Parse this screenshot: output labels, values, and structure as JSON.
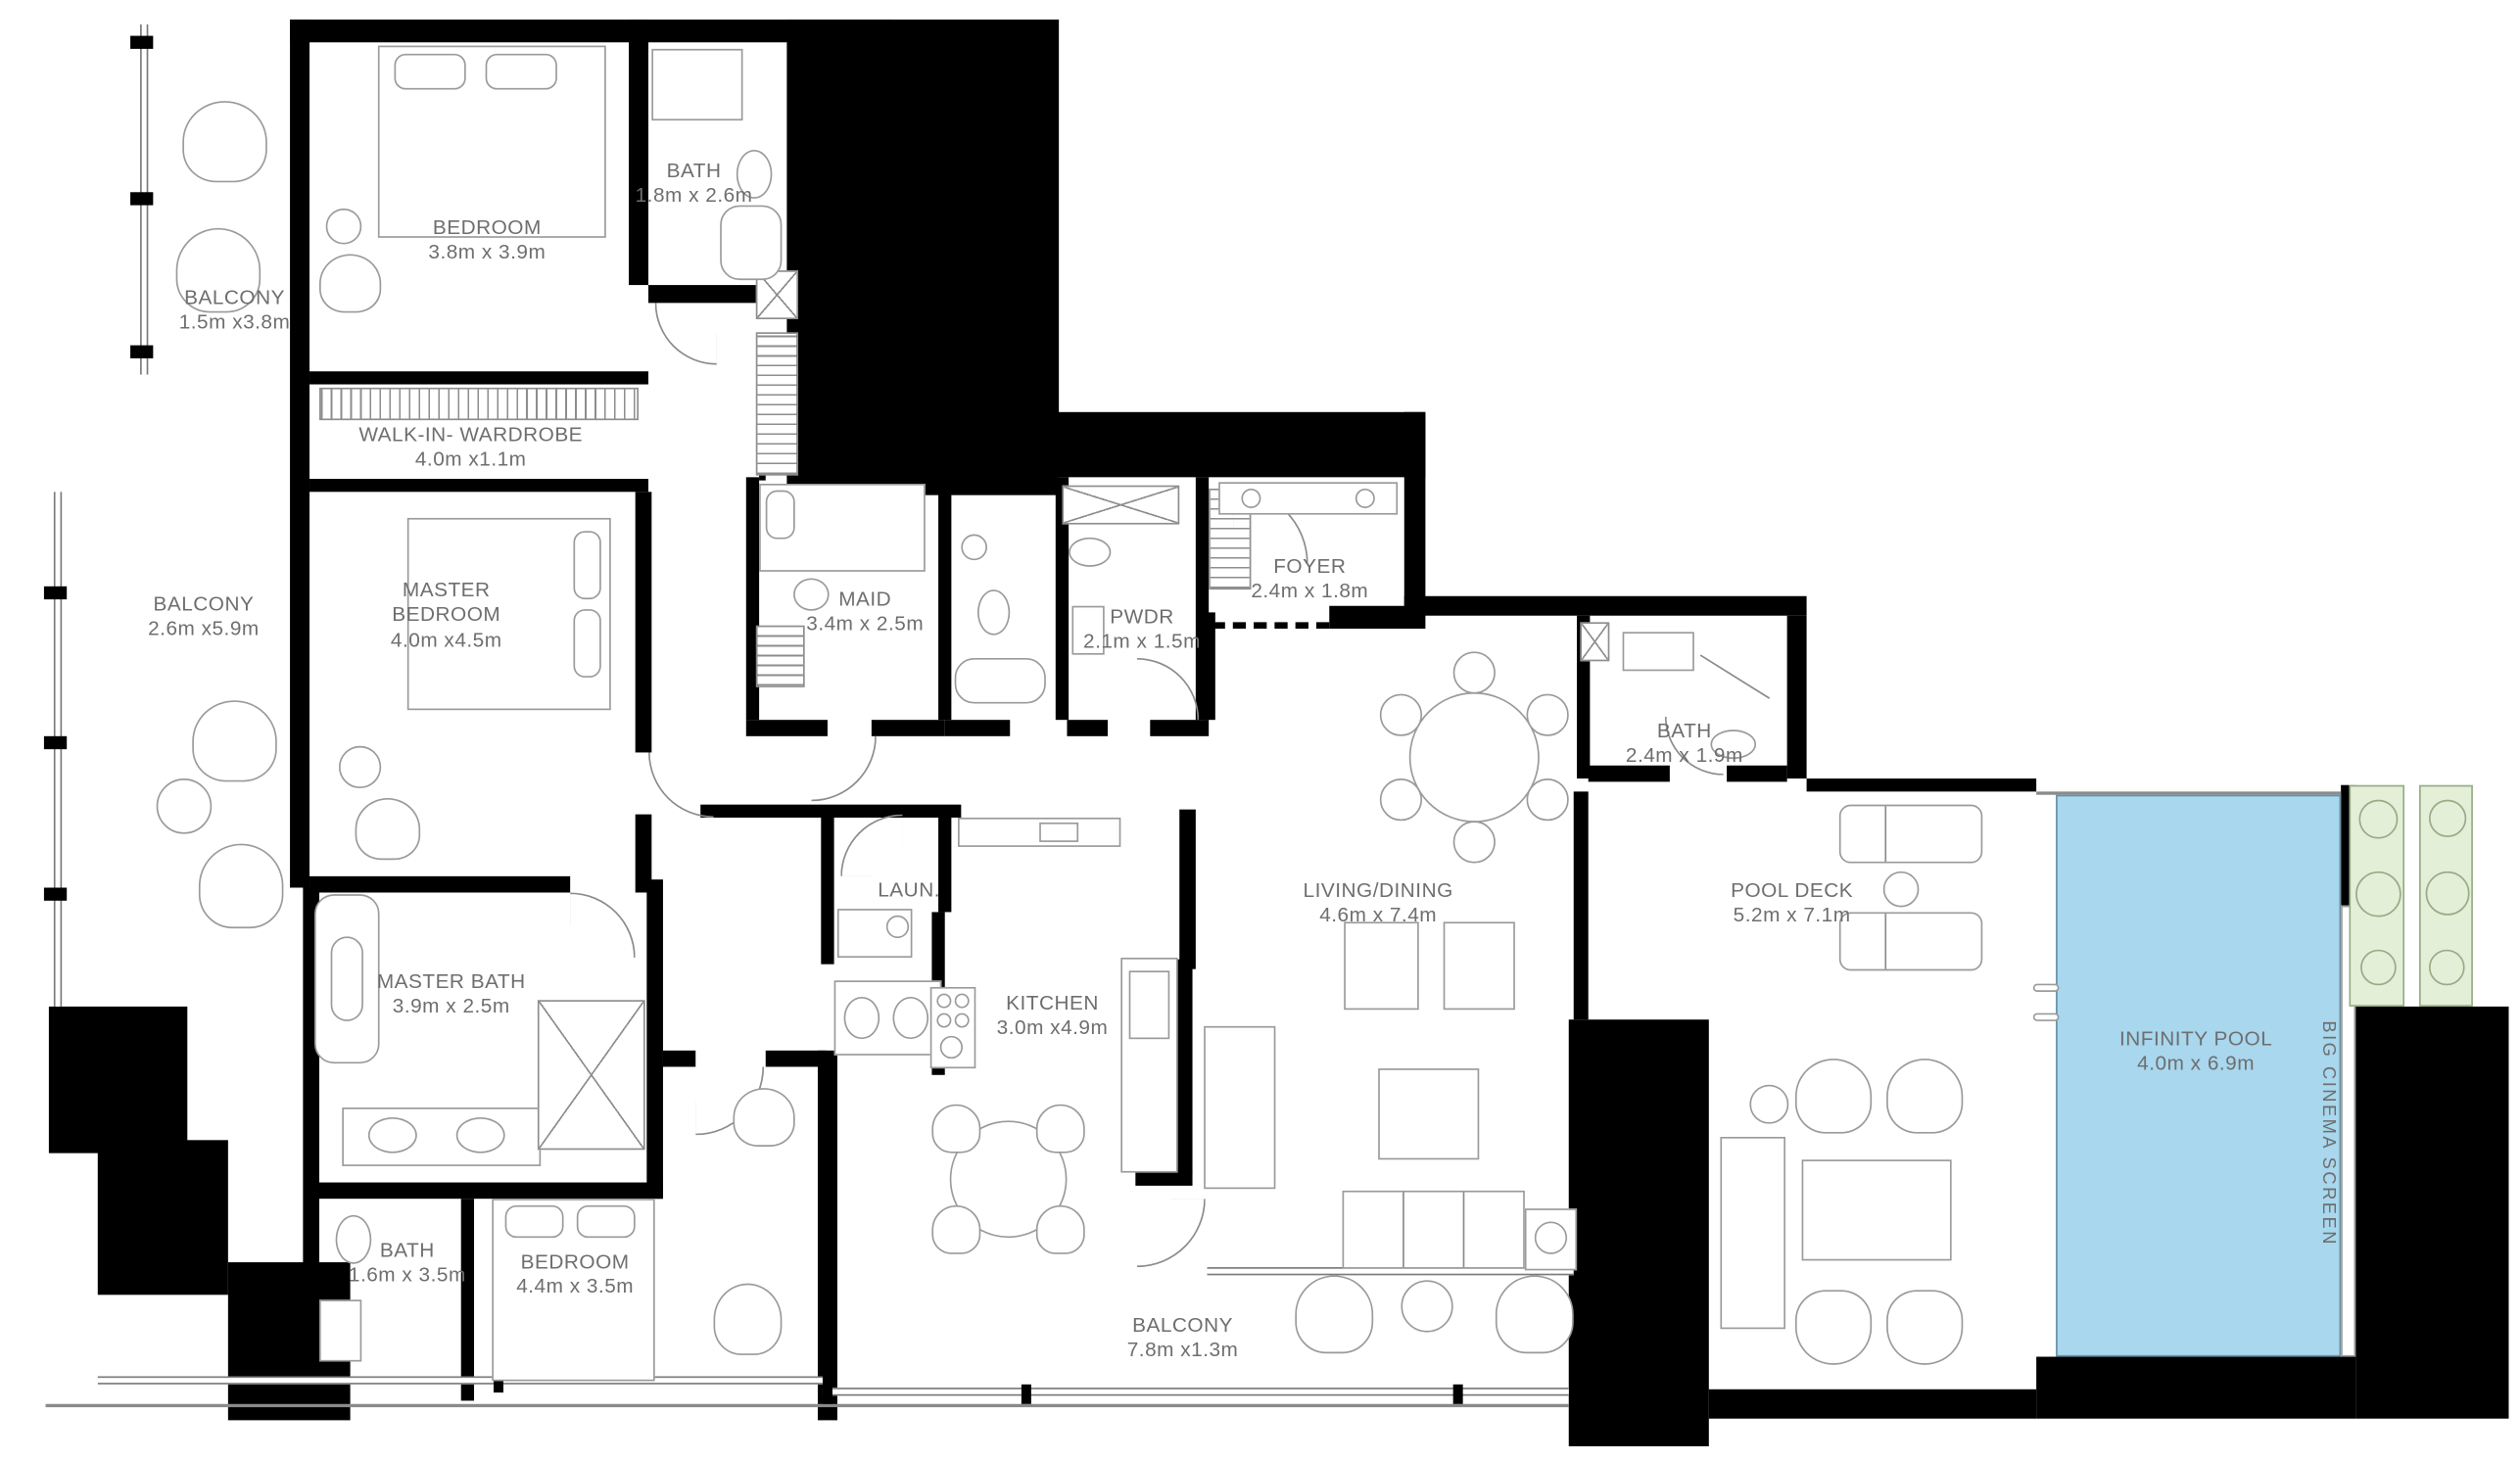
{
  "colors": {
    "wall": "#000000",
    "pool_fill": "#a8d7ee",
    "pool_border": "#6b8fa3",
    "planter_fill": "#e3efd7",
    "planter_border": "#97ab85",
    "label_color": "#6e6e6e"
  },
  "rooms": [
    {
      "id": "balcony-top",
      "name": "BALCONY",
      "dims": "1.5m x3.8m"
    },
    {
      "id": "bedroom-top",
      "name": "BEDROOM",
      "dims": "3.8m x 3.9m"
    },
    {
      "id": "bath-top",
      "name": "BATH",
      "dims": "1.8m x 2.6m"
    },
    {
      "id": "walk-in-wardrobe",
      "name": "WALK-IN- WARDROBE",
      "dims": "4.0m x1.1m"
    },
    {
      "id": "balcony-left",
      "name": "BALCONY",
      "dims": "2.6m x5.9m"
    },
    {
      "id": "master-bedroom",
      "name": "MASTER BEDROOM",
      "dims": "4.0m x4.5m"
    },
    {
      "id": "maid",
      "name": "MAID",
      "dims": "3.4m x 2.5m"
    },
    {
      "id": "pwdr",
      "name": "PWDR",
      "dims": "2.1m x 1.5m"
    },
    {
      "id": "foyer",
      "name": "FOYER",
      "dims": "2.4m x 1.8m"
    },
    {
      "id": "bath-guest",
      "name": "BATH",
      "dims": "2.4m x 1.9m"
    },
    {
      "id": "living-dining",
      "name": "LIVING/DINING",
      "dims": "4.6m x 7.4m"
    },
    {
      "id": "pool-deck",
      "name": "POOL DECK",
      "dims": "5.2m x 7.1m"
    },
    {
      "id": "infinity-pool",
      "name": "INFINITY POOL",
      "dims": "4.0m x 6.9m"
    },
    {
      "id": "master-bath",
      "name": "MASTER BATH",
      "dims": "3.9m x 2.5m"
    },
    {
      "id": "laundry",
      "name": "LAUN.",
      "dims": ""
    },
    {
      "id": "kitchen",
      "name": "KITCHEN",
      "dims": "3.0m x4.9m"
    },
    {
      "id": "bath-3",
      "name": "BATH",
      "dims": "1.6m x 3.5m"
    },
    {
      "id": "bedroom-3",
      "name": "BEDROOM",
      "dims": "4.4m x 3.5m"
    },
    {
      "id": "balcony-bottom",
      "name": "BALCONY",
      "dims": "7.8m x1.3m"
    },
    {
      "id": "cinema-screen",
      "name": "BIG CINEMA SCREEN",
      "dims": ""
    }
  ]
}
